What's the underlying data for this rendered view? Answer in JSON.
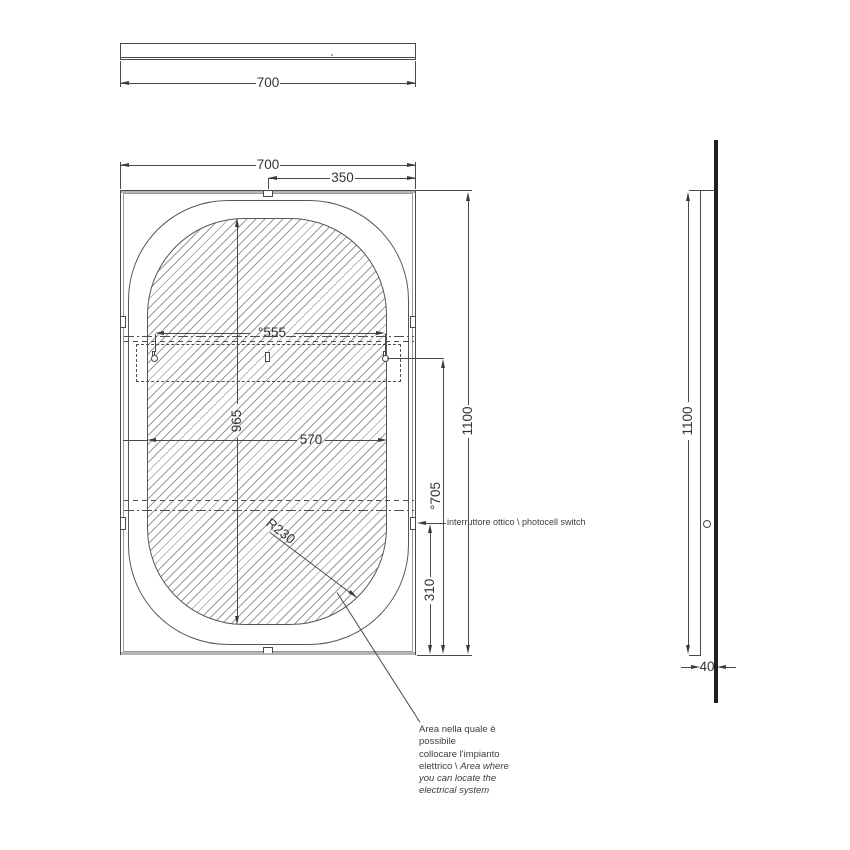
{
  "drawing": {
    "type": "technical-drawing-mirror",
    "colors": {
      "line": "#4a4a4a",
      "frame": "#b5b5b5",
      "hatch": "#9b9b9b",
      "wall": "#202020",
      "text": "#353535"
    }
  },
  "top_view": {
    "width": "700"
  },
  "front_view": {
    "dim_width": "700",
    "dim_center_to_edge": "350",
    "dim_slot_spacing": "°555",
    "dim_inner_width": "570",
    "dim_inner_height": "965",
    "dim_height": "1100",
    "dim_slots_to_bottom": "°705",
    "dim_switch_to_bottom": "310",
    "dim_corner_radius": "R230",
    "photocell_label": "interruttore ottico \\ photocell switch"
  },
  "side_view": {
    "height": "1100",
    "depth": "40"
  },
  "annotation": {
    "line1": "Area nella quale è",
    "line2": "possibile",
    "line3": "collocare l'impianto",
    "line4_regular": "elettrico \\ ",
    "line4_italic": "Area where",
    "line5": "you can locate the",
    "line6": "electrical system"
  }
}
